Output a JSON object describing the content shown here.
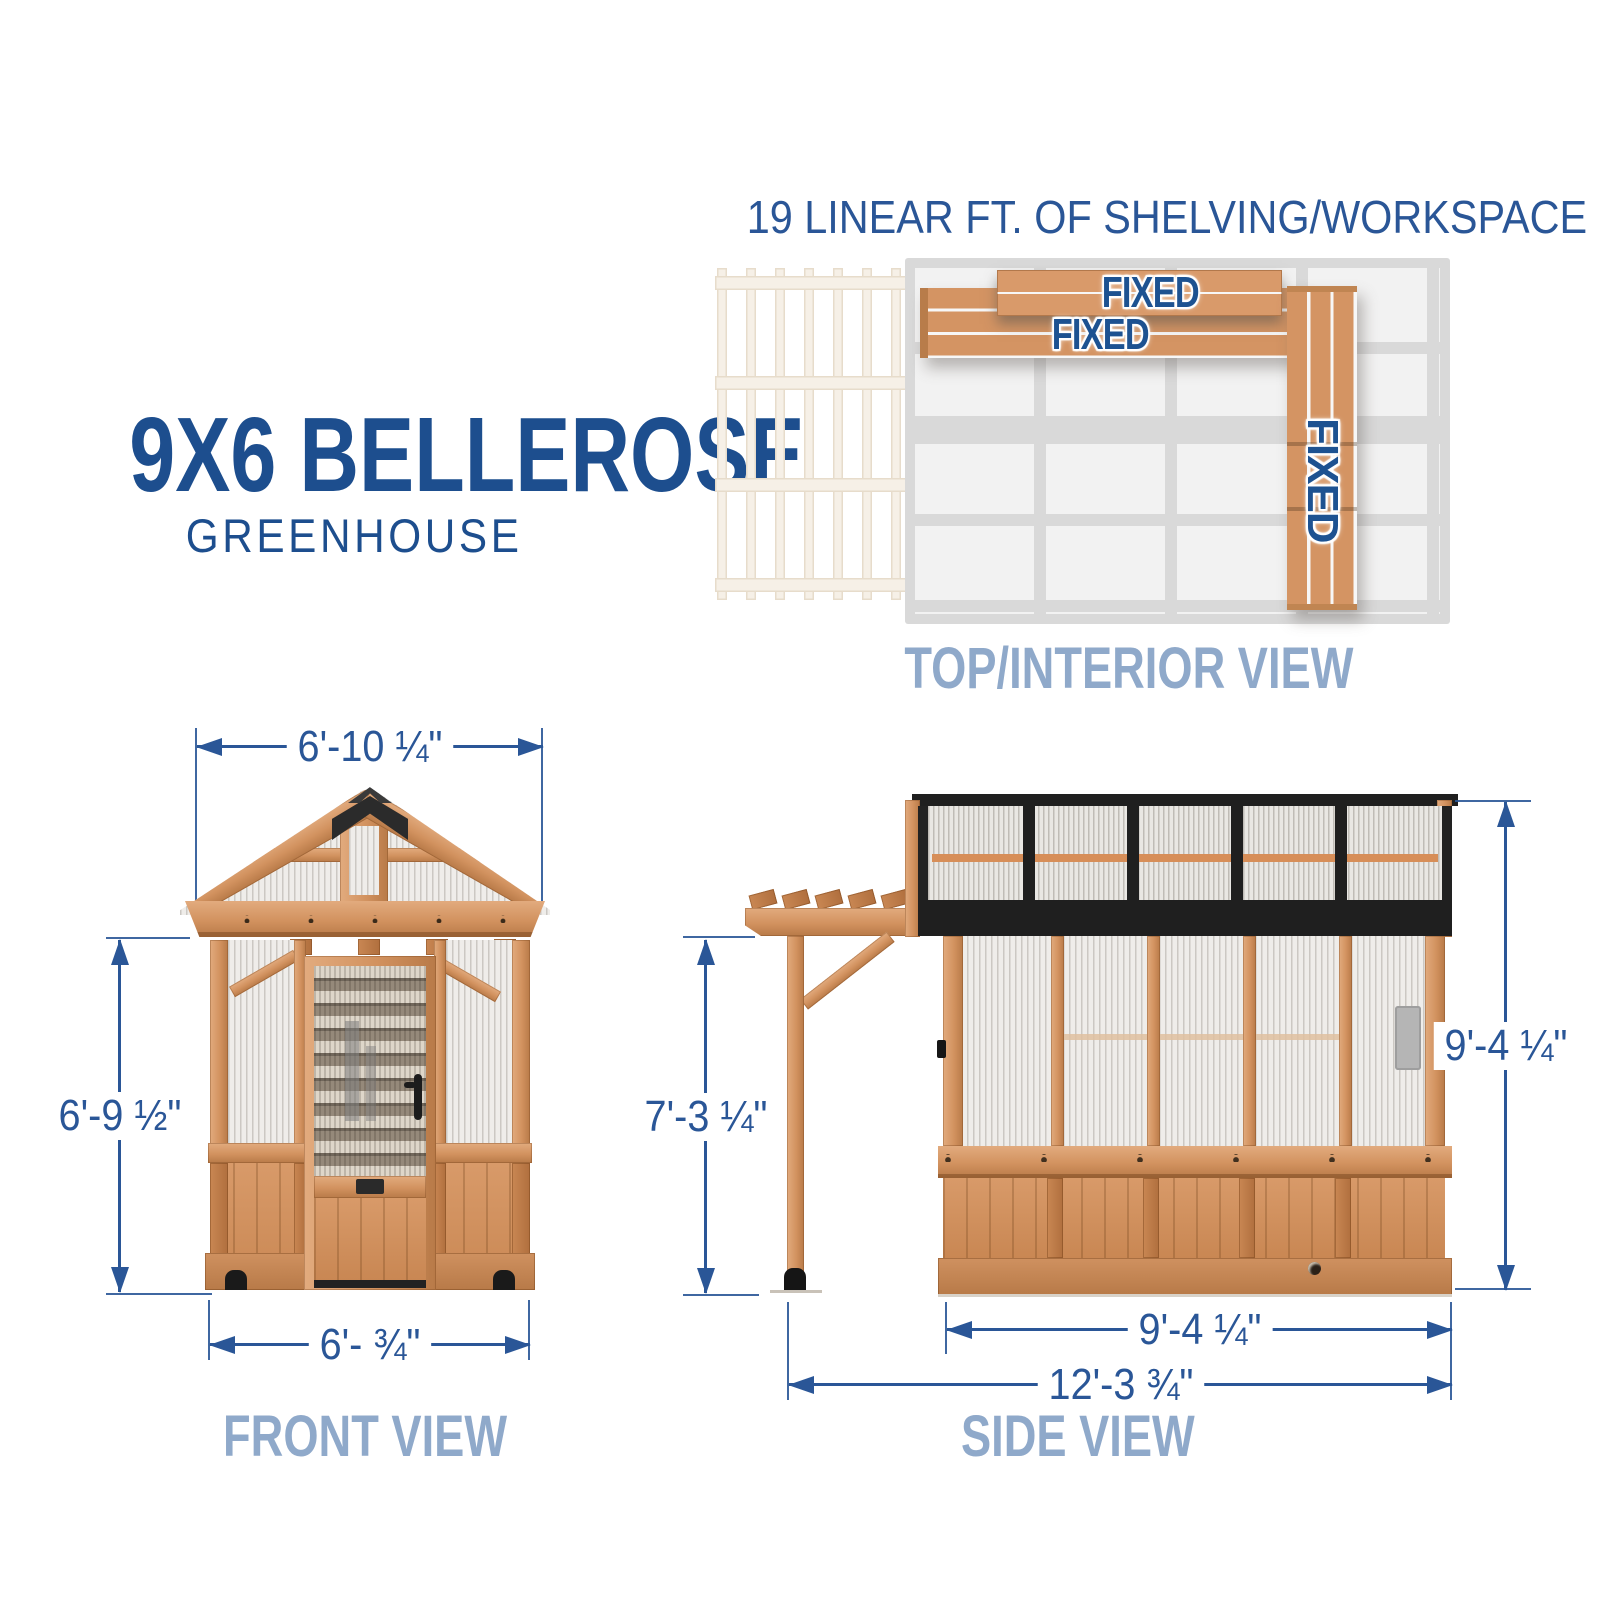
{
  "title": {
    "line1": "9X6 BELLEROSE",
    "line2": "GREENHOUSE"
  },
  "top_view": {
    "heading": "19 LINEAR FT. OF SHELVING/WORKSPACE",
    "caption": "TOP/INTERIOR VIEW",
    "shelf_top_label": "FIXED",
    "shelf_wide_label": "FIXED",
    "shelf_side_label": "FIXED"
  },
  "front_view": {
    "caption": "FRONT VIEW",
    "dim_width_top": "6'-10 ¼\"",
    "dim_height_left": "6'-9 ½\"",
    "dim_width_bottom": "6'- ¾\""
  },
  "side_view": {
    "caption": "SIDE VIEW",
    "dim_pergola_height": "7'-3 ¼\"",
    "dim_total_height": "9'-4 ¼\"",
    "dim_body_width": "9'-4 ¼\"",
    "dim_total_width": "12'-3 ¾\""
  },
  "colors": {
    "navy": "#1d4e8e",
    "dim": "#2a5697",
    "caption": "#8fa9ca",
    "wood-hi": "#e2ab7e",
    "wood-mid": "#d2925f",
    "wood-lo": "#b87a48",
    "wood-edge": "#9a6234",
    "black-part": "#1f1f1f",
    "glaze": "#efedea",
    "shelf-orange": "#d78e58",
    "plan-gray": "#d9d9d9",
    "plan-cell": "#f2f2f2",
    "faint-wood": "#f6f0e7",
    "faint-edge": "#e7dccb"
  }
}
